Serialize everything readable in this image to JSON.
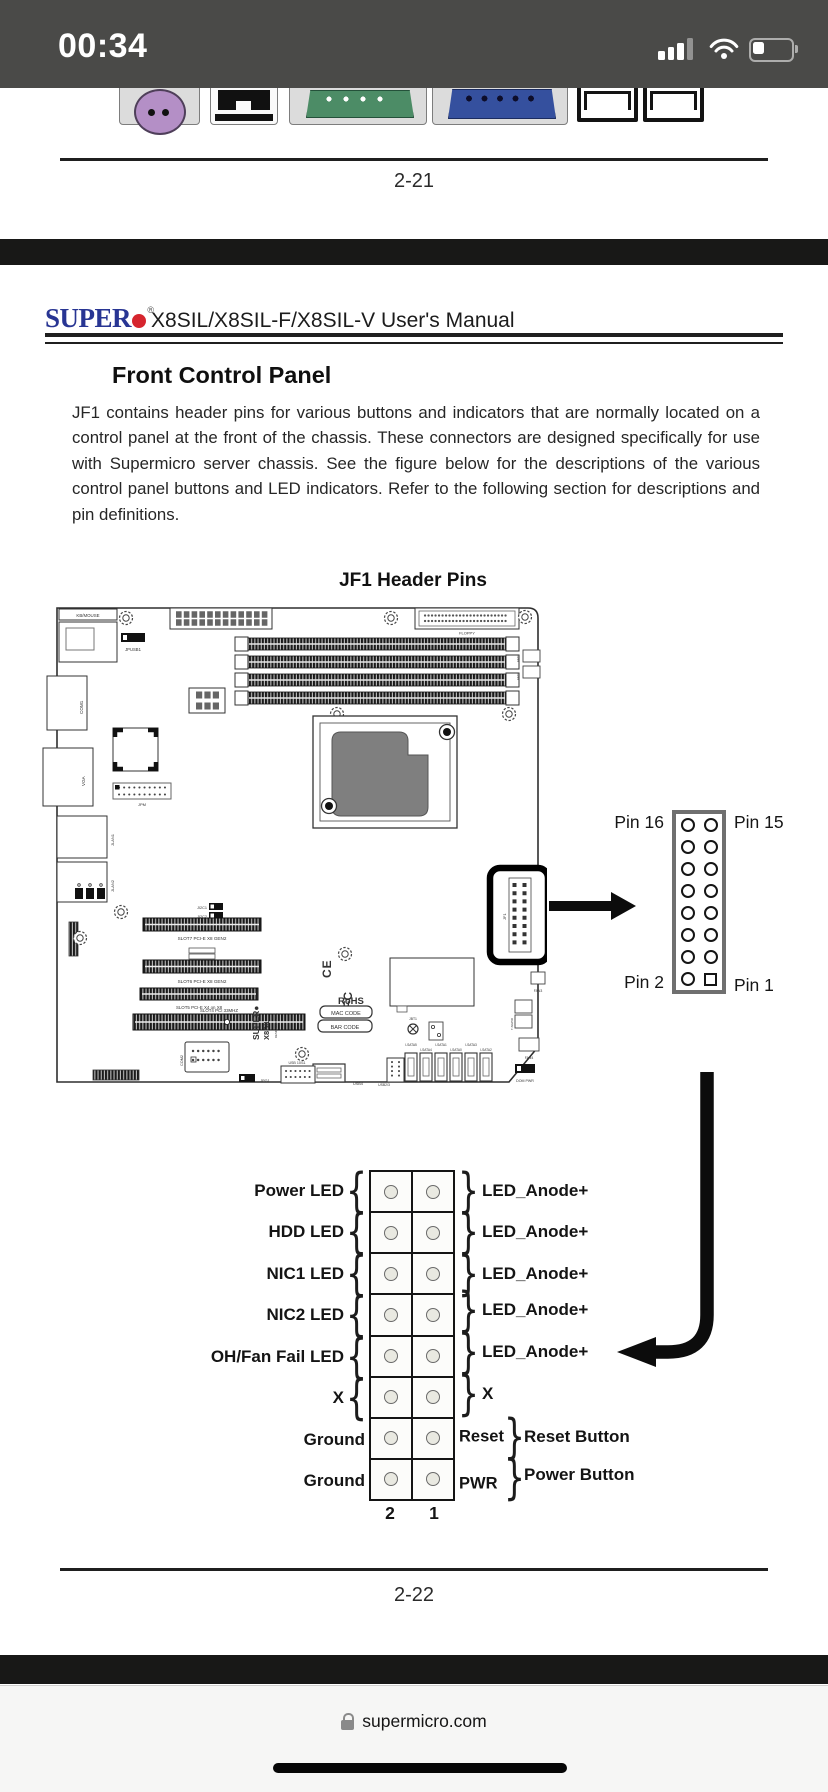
{
  "status_bar": {
    "time": "00:34"
  },
  "prev_page": {
    "page_number": "2-21"
  },
  "doc": {
    "logo_text": "SUPER",
    "logo_reg": "®",
    "header_title": "X8SIL/X8SIL-F/X8SIL-V User's Manual",
    "section_heading": "Front Control Panel",
    "body": "JF1 contains header pins for various buttons and indicators that are normally located on a control panel at the front of the chassis. These connectors are designed specifically for use with Supermicro server chassis. See the figure below for the descriptions of the various control panel buttons and LED indicators. Refer to the following section for descriptions and pin definitions.",
    "figure_title": "JF1 Header Pins",
    "page_number": "2-22"
  },
  "board": {
    "kb_mouse": "KB/MOUSE",
    "com1": "COM1",
    "vga": "VGA",
    "jlan1": "JLAN1",
    "jlan2": "JLAN2",
    "jpusb1": "JPUSB1",
    "floppy": "FLOPPY",
    "jpm": "JPM",
    "ji2c1": "JI2C1",
    "ji2c2": "JI2C2",
    "slot7": "SLOT7 PCI-E X8 GEN2",
    "slot6": "SLOT6 PCI-E X8 GEN2",
    "slot5": "SLOT5 PCI-E X4 on X8",
    "slot4": "SLOT4 PCI 33MHZ",
    "logo_vert": "SUPER●",
    "model_vert": "X8SIL",
    "designed": "DESIGNED IN USA",
    "ce": "CE",
    "fcc": "FC",
    "rohs": "RoHS",
    "mac_code": "MAC CODE",
    "bar_code": "BAR CODE",
    "jbt1": "JBT1",
    "jf1": "JF1",
    "com2": "COM2",
    "jpg1": "JPG1",
    "usb1011": "USB 10/11",
    "usb4": "USB4",
    "usb23": "USB2/3",
    "t_sgpio": "T-SGPIO",
    "fan1": "FAN1",
    "fan2": "FAN2",
    "fan3": "FAN3",
    "fan4": "FAN4",
    "dom_pwr": "DOM PWR",
    "sata": [
      "I-SATA5",
      "I-SATA4",
      "I-SATA1",
      "I-SATA0",
      "I-SATA3",
      "I-SATA2"
    ]
  },
  "pin_header": {
    "pin16": "Pin 16",
    "pin15": "Pin 15",
    "pin2": "Pin 2",
    "pin1": "Pin 1"
  },
  "pin_table": {
    "rows": [
      {
        "left": "Power LED",
        "right": "LED_Anode+"
      },
      {
        "left": "HDD LED",
        "right": "LED_Anode+"
      },
      {
        "left": "NIC1 LED",
        "right": "LED_Anode+"
      },
      {
        "left": "NIC2 LED",
        "right": "LED_Anode+"
      },
      {
        "left": "OH/Fan Fail LED",
        "right": "LED_Anode+"
      },
      {
        "left": "X",
        "right": "X"
      },
      {
        "left": "Ground",
        "pin": "Reset",
        "right": "Reset Button"
      },
      {
        "left": "Ground",
        "pin": "PWR",
        "right": "Power Button"
      }
    ],
    "col_left": "2",
    "col_right": "1"
  },
  "browser": {
    "url": "supermicro.com"
  },
  "rear_ports": [
    "ps2-mouse-port",
    "parallel-port",
    "serial-com-port",
    "vga-port",
    "lan-port",
    "lan-port"
  ],
  "colors": {
    "logo_blue": "#283593",
    "logo_red": "#d6252e",
    "ps2_purple": "#b48fc6",
    "serial_green": "#4c8c66",
    "vga_blue": "#35509e",
    "status_bar_bg": "#4a4a48"
  }
}
